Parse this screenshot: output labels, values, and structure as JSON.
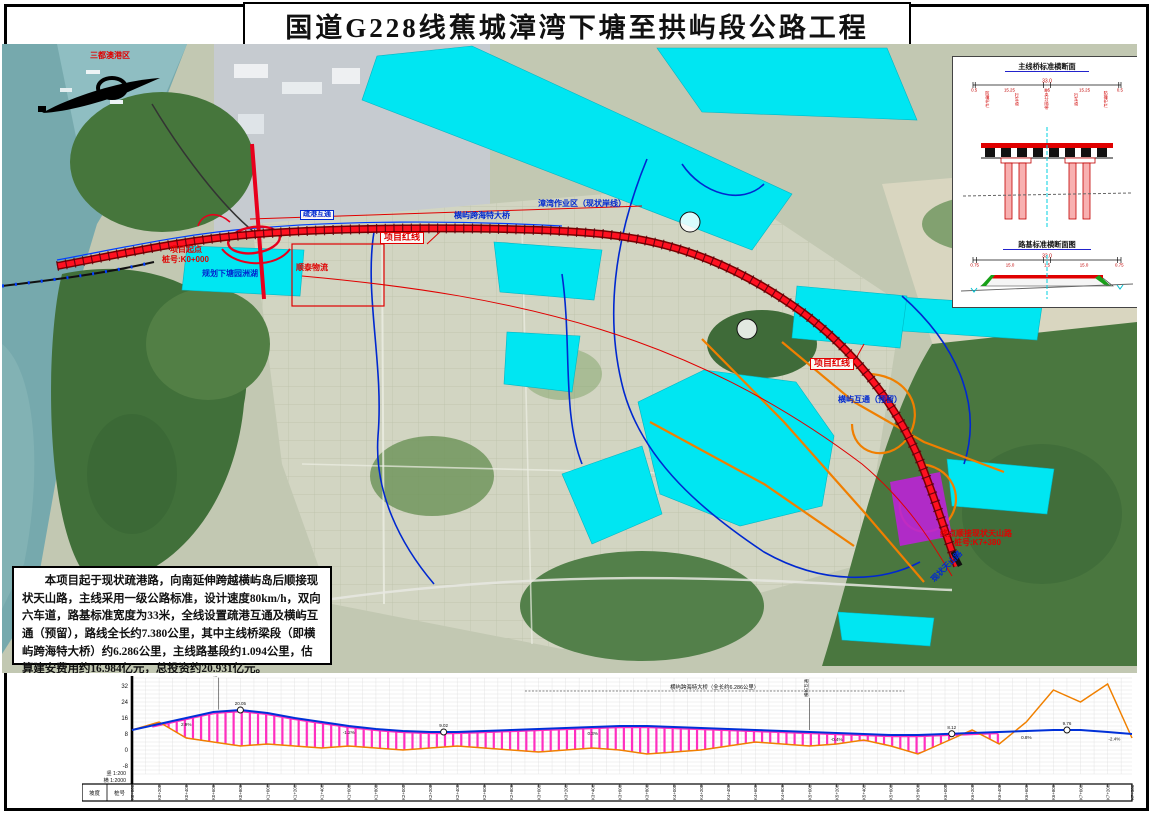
{
  "title": "国道G228线蕉城漳湾下塘至拱屿段公路工程",
  "description": {
    "text": "本项目起于现状疏港路，向南延伸跨越横屿岛后顺接现状天山路，主线采用一级公路标准，设计速度80km/h，双向六车道，路基标准宽度为33米，全线设置疏港互通及横屿互通（预留），路线全长约7.380公里，其中主线桥梁段（即横屿跨海特大桥）约6.286公里，主线路基段约1.094公里，估算建安费用约16.984亿元，总投资约20.931亿元。"
  },
  "cross_sections": {
    "bridge_title": "主线桥标准横断面",
    "roadbed_title": "路基标准横断面图",
    "total_width": "33.0",
    "bridge_dims": [
      "0.5",
      "15.25",
      "1.5",
      "15.25",
      "0.5"
    ],
    "bridge_lane_labels": [
      "防撞护栏",
      "行车道",
      "中央分隔带",
      "行车道",
      "防撞护栏"
    ],
    "roadbed_dims": [
      "0.75",
      "15.0",
      "1.5",
      "15.0",
      "0.75"
    ],
    "roadbed_lane_labels": [
      "护坡道",
      "行车道",
      "中央分隔带",
      "行车道",
      "护坡道"
    ]
  },
  "map": {
    "labels": [
      {
        "text": "三都澳港区",
        "x": 88,
        "y": 8,
        "style": "red"
      },
      {
        "text": "项目红线",
        "x": 378,
        "y": 188,
        "style": "red-box"
      },
      {
        "text": "项目红线",
        "x": 808,
        "y": 314,
        "style": "red-box"
      },
      {
        "text": "项目起点",
        "x": 168,
        "y": 202,
        "style": "red"
      },
      {
        "text": "桩号:K0+000",
        "x": 160,
        "y": 212,
        "style": "red"
      },
      {
        "text": "规划下塘园洲湖",
        "x": 200,
        "y": 226,
        "style": "blue"
      },
      {
        "text": "顺泰物流",
        "x": 294,
        "y": 220,
        "style": "red"
      },
      {
        "text": "漳湾作业区（现状岸线）",
        "x": 536,
        "y": 156,
        "style": "blue"
      },
      {
        "text": "横屿跨海特大桥",
        "x": 452,
        "y": 168,
        "style": "blue"
      },
      {
        "text": "疏港互通",
        "x": 298,
        "y": 166,
        "style": "blue-box"
      },
      {
        "text": "横屿互通（预留）",
        "x": 836,
        "y": 352,
        "style": "blue"
      },
      {
        "text": "终点顺接现状天山路",
        "x": 938,
        "y": 486,
        "style": "red"
      },
      {
        "text": "桩号:K7+380",
        "x": 952,
        "y": 495,
        "style": "red"
      },
      {
        "text": "现状天山路",
        "x": 928,
        "y": 534,
        "style": "blue",
        "rotate": -45
      }
    ]
  },
  "chart_data": {
    "type": "line",
    "x_unit": "m",
    "x": [
      0,
      200,
      400,
      600,
      800,
      1000,
      1200,
      1400,
      1600,
      1800,
      2000,
      2200,
      2400,
      2600,
      2800,
      3000,
      3200,
      3400,
      3600,
      3800,
      4000,
      4200,
      4400,
      4600,
      4800,
      5000,
      5200,
      5400,
      5600,
      5800,
      6000,
      6200,
      6400,
      6600,
      6800,
      7000,
      7200,
      7380
    ],
    "series": [
      {
        "name": "地面线",
        "color": "#f08000",
        "values": [
          10,
          14,
          6,
          4,
          2,
          3,
          2,
          1,
          2,
          1,
          0,
          1,
          2,
          1,
          0,
          -1,
          0,
          1,
          0,
          -2,
          -1,
          0,
          2,
          4,
          3,
          2,
          3,
          5,
          2,
          -2,
          4,
          10,
          3,
          14,
          30,
          24,
          33,
          6
        ]
      },
      {
        "name": "设计线",
        "color": "#0030d8",
        "values": [
          10,
          13,
          16,
          19,
          20,
          18.5,
          16,
          14,
          12,
          10.5,
          9.5,
          9,
          9,
          9.5,
          10,
          10.5,
          11,
          11.5,
          12,
          12,
          11.5,
          11,
          10.5,
          10,
          9.5,
          9,
          8.5,
          8,
          7.5,
          7.5,
          8,
          8.5,
          9,
          9.5,
          10,
          10,
          9,
          8
        ]
      }
    ],
    "bridge_range": [
      150,
      6436
    ],
    "ylim": [
      -12,
      36
    ],
    "elev_ticks": [
      32,
      24,
      16,
      8,
      0,
      -8
    ],
    "v_scale": "竖 1:200",
    "h_scale": "横 1:2000",
    "row_headers": [
      "坡度",
      "桩号"
    ],
    "bridge_annotation": "横屿跨海特大桥（全长约6.286公里）",
    "curve_markers": [
      {
        "s": 800,
        "label": "20.05"
      },
      {
        "s": 2300,
        "label": "9.02"
      },
      {
        "s": 6050,
        "label": "8.12"
      },
      {
        "s": 6900,
        "label": "9.76"
      }
    ],
    "grade_labels": [
      {
        "s": 400,
        "text": "2.9%"
      },
      {
        "s": 1600,
        "text": "-1.2%"
      },
      {
        "s": 3400,
        "text": "0.3%"
      },
      {
        "s": 5200,
        "text": "-0.4%"
      },
      {
        "s": 6600,
        "text": "0.8%"
      },
      {
        "s": 7250,
        "text": "-2.4%"
      }
    ],
    "vertical_marks": [
      {
        "s": 640,
        "text": "疏港互通"
      },
      {
        "s": 5000,
        "text": "横屿互通（预留）"
      }
    ]
  }
}
